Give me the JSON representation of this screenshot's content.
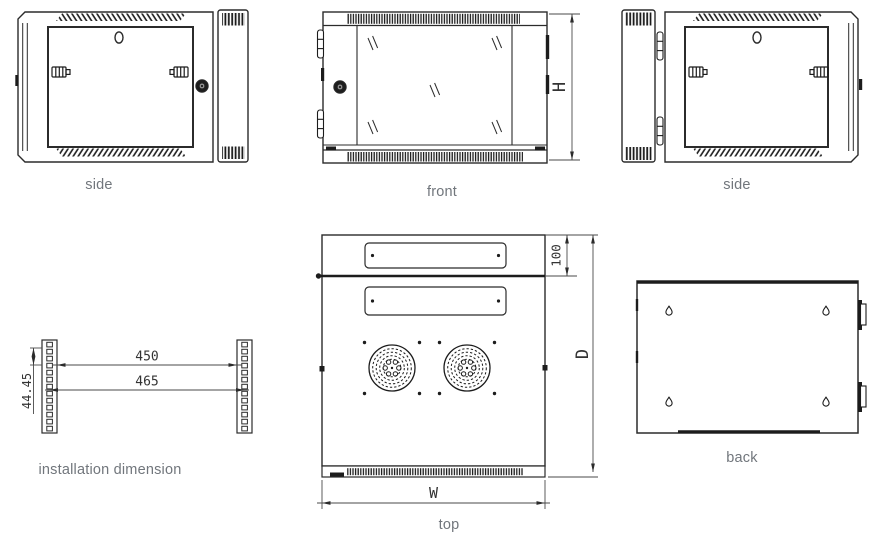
{
  "page": {
    "background": "#ffffff",
    "width": 873,
    "height": 539
  },
  "views": {
    "side_left": {
      "caption": "side"
    },
    "front": {
      "caption": "front",
      "dims": {
        "height": "H"
      }
    },
    "side_right": {
      "caption": "side"
    },
    "installation": {
      "caption": "installation dimension",
      "dims": {
        "unit_pitch": "44.45",
        "inner_span": "450",
        "center_span": "465"
      }
    },
    "top": {
      "caption": "top",
      "dims": {
        "top_section": "100",
        "depth": "D",
        "width": "W"
      }
    },
    "back": {
      "caption": "back"
    }
  },
  "colors": {
    "line": "#2b2b2b",
    "caption_text": "#71767c",
    "dimension_text": "#333333"
  }
}
